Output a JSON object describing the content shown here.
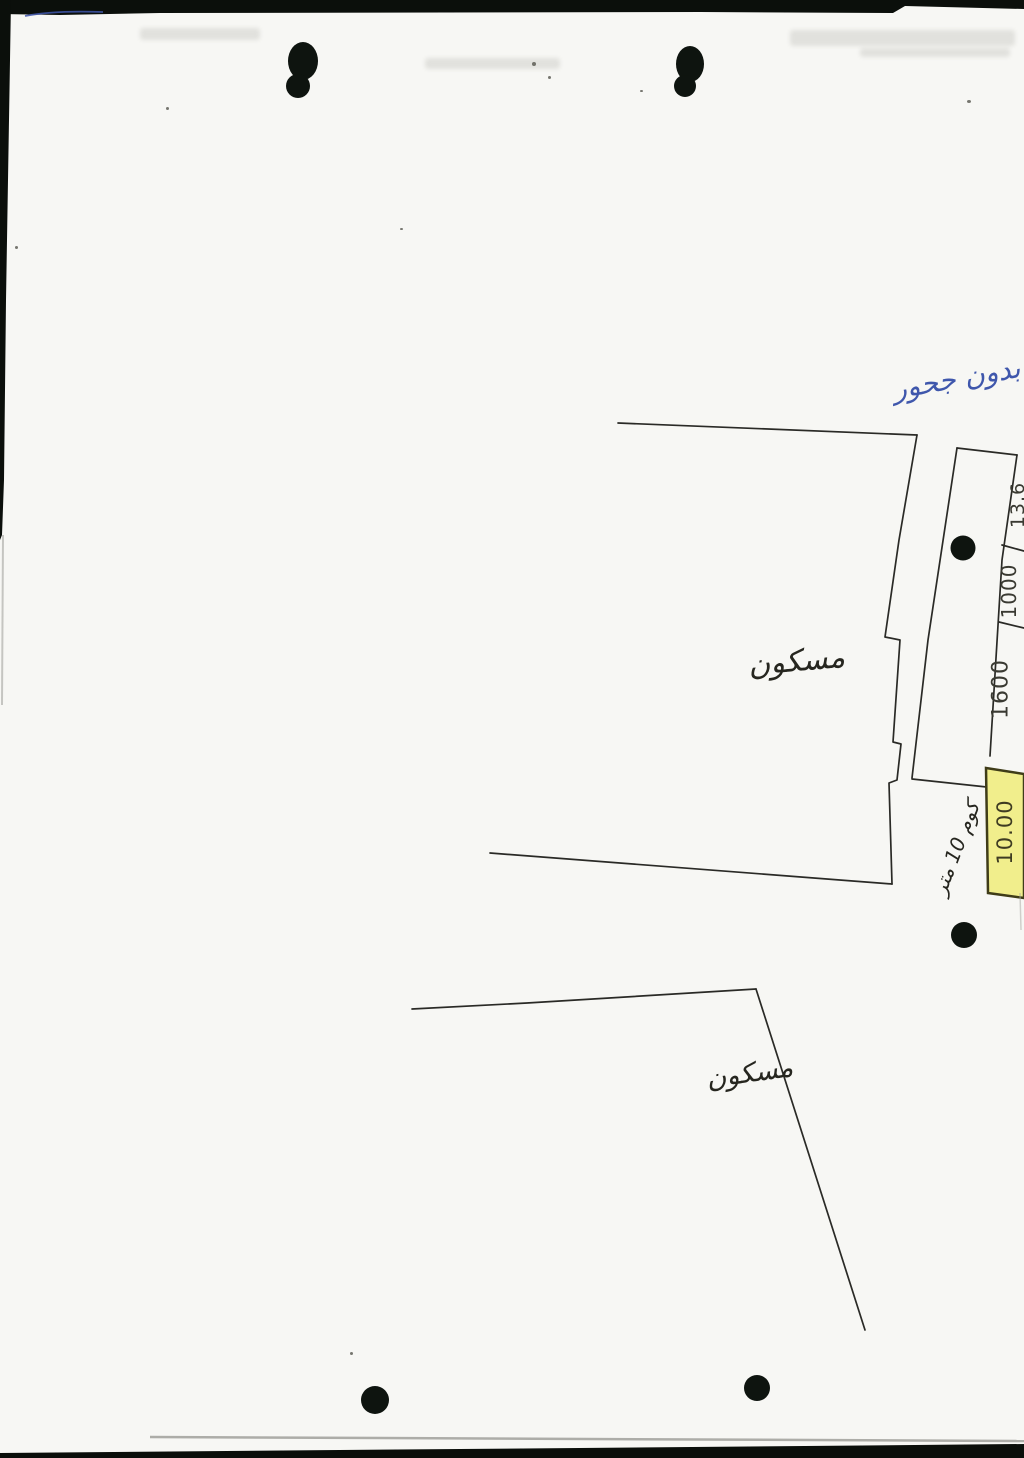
{
  "annotations": {
    "blue_note": "بدون جحور",
    "upper_plot_label": "مسكون",
    "lower_plot_label": "مسكون",
    "strip_note": "كوم 10 متر"
  },
  "measurements": {
    "cells": [
      {
        "value": "13.6",
        "highlighted": false
      },
      {
        "value": "1000",
        "highlighted": false
      },
      {
        "value": "1600",
        "highlighted": false
      },
      {
        "value": "10.00",
        "highlighted": true
      }
    ],
    "highlight_color": "#f1ee8c"
  },
  "colors": {
    "paper": "#f7f7f4",
    "pencil_ink": "#2a2a26",
    "blue_ink": "#3f57ac",
    "scan_edge": "#0b0f0b"
  }
}
